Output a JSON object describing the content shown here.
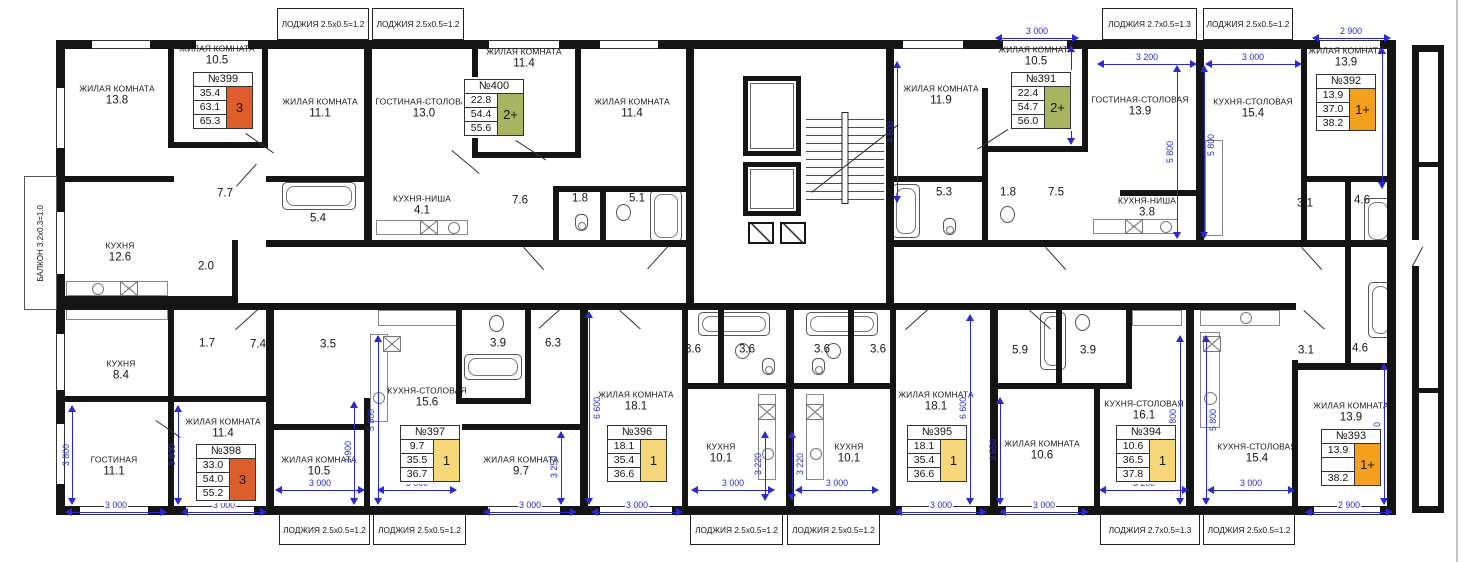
{
  "colors": {
    "wall": "#141414",
    "dimension_blue": "#2a2ad4",
    "badge_3_rooms": "#dd5e2b",
    "badge_2plus_rooms": "#a8b45f",
    "badge_1_room": "#f6d87b",
    "badge_1plus_room": "#f2a01d"
  },
  "balcony_label": "БАЛКОН 3.2х0.3=1.0",
  "loggias": {
    "top": [
      "ЛОДЖИЯ 2.5х0.5=1.2",
      "ЛОДЖИЯ 2.5х0.5=1.2",
      "ЛОДЖИЯ 2.7х0.5=1.3",
      "ЛОДЖИЯ 2.5х0.5=1.2"
    ],
    "bottom": [
      "ЛОДЖИЯ 2.5х0.5=1.2",
      "ЛОДЖИЯ 2.5х0.5=1.2",
      "ЛОДЖИЯ 2.5х0.5=1.2",
      "ЛОДЖИЯ 2.5х0.5=1.2",
      "ЛОДЖИЯ 2.7х0.5=1.3",
      "ЛОДЖИЯ 2.5х0.5=1.2"
    ]
  },
  "apartments": [
    {
      "num": "№399",
      "v1": "35.4",
      "v2": "63.1",
      "v3": "65.3",
      "badge": "3"
    },
    {
      "num": "№400",
      "v1": "22.8",
      "v2": "54.4",
      "v3": "55.6",
      "badge": "2+"
    },
    {
      "num": "№391",
      "v1": "22.4",
      "v2": "54.7",
      "v3": "56.0",
      "badge": "2+"
    },
    {
      "num": "№392",
      "v1": "13.9",
      "v2": "37.0",
      "v3": "38.2",
      "badge": "1+"
    },
    {
      "num": "№398",
      "v1": "33.0",
      "v2": "54.0",
      "v3": "55.2",
      "badge": "3"
    },
    {
      "num": "№397",
      "v1": "9.7",
      "v2": "35.5",
      "v3": "36.7",
      "badge": "1"
    },
    {
      "num": "№396",
      "v1": "18.1",
      "v2": "35.4",
      "v3": "36.6",
      "badge": "1"
    },
    {
      "num": "№395",
      "v1": "18.1",
      "v2": "35.4",
      "v3": "36.6",
      "badge": "1"
    },
    {
      "num": "№394",
      "v1": "10.6",
      "v2": "36.5",
      "v3": "37.8",
      "badge": "1"
    },
    {
      "num": "№393",
      "v1": "13.9",
      "v2": "37.0",
      "v3": "38.2",
      "badge": "1+"
    }
  ],
  "rooms": [
    {
      "n": "ЖИЛАЯ КОМНАТА",
      "a": "13.8"
    },
    {
      "n": "ЖИЛАЯ КОМНАТА",
      "a": "10.5"
    },
    {
      "n": "ЖИЛАЯ КОМНАТА",
      "a": "11.1"
    },
    {
      "n": "",
      "a": "7.7"
    },
    {
      "n": "КУХНЯ",
      "a": "12.6"
    },
    {
      "n": "",
      "a": "2.0"
    },
    {
      "n": "",
      "a": "5.4"
    },
    {
      "n": "ГОСТИНАЯ-СТОЛОВАЯ",
      "a": "13.0"
    },
    {
      "n": "ЖИЛАЯ КОМНАТА",
      "a": "11.4"
    },
    {
      "n": "ЖИЛАЯ КОМНАТА",
      "a": "11.4"
    },
    {
      "n": "КУХНЯ-НИША",
      "a": "4.1"
    },
    {
      "n": "",
      "a": "7.6"
    },
    {
      "n": "",
      "a": "1.8"
    },
    {
      "n": "",
      "a": "5.1"
    },
    {
      "n": "ЖИЛАЯ КОМНАТА",
      "a": "11.9"
    },
    {
      "n": "",
      "a": "5.3"
    },
    {
      "n": "",
      "a": "1.8"
    },
    {
      "n": "",
      "a": "7.5"
    },
    {
      "n": "ЖИЛАЯ КОМНАТА",
      "a": "10.5"
    },
    {
      "n": "ГОСТИНАЯ-СТОЛОВАЯ",
      "a": "13.9"
    },
    {
      "n": "КУХНЯ-НИША",
      "a": "3.8"
    },
    {
      "n": "КУХНЯ-СТОЛОВАЯ",
      "a": "15.4"
    },
    {
      "n": "ЖИЛАЯ КОМНАТА",
      "a": "13.9"
    },
    {
      "n": "",
      "a": "3.1"
    },
    {
      "n": "",
      "a": "4.6"
    },
    {
      "n": "",
      "a": "1.7"
    },
    {
      "n": "",
      "a": "7.4"
    },
    {
      "n": "",
      "a": "3.5"
    },
    {
      "n": "",
      "a": "3.9"
    },
    {
      "n": "",
      "a": "6.3"
    },
    {
      "n": "КУХНЯ",
      "a": "8.4"
    },
    {
      "n": "ГОСТИНАЯ",
      "a": "11.1"
    },
    {
      "n": "ЖИЛАЯ КОМНАТА",
      "a": "11.4"
    },
    {
      "n": "ЖИЛАЯ КОМНАТА",
      "a": "10.5"
    },
    {
      "n": "КУХНЯ-СТОЛОВАЯ",
      "a": "15.6"
    },
    {
      "n": "ЖИЛАЯ КОМНАТА",
      "a": "9.7"
    },
    {
      "n": "",
      "a": "3.6"
    },
    {
      "n": "",
      "a": "3.6"
    },
    {
      "n": "",
      "a": "3.6"
    },
    {
      "n": "",
      "a": "3.6"
    },
    {
      "n": "ЖИЛАЯ КОМНАТА",
      "a": "18.1"
    },
    {
      "n": "КУХНЯ",
      "a": "10.1"
    },
    {
      "n": "КУХНЯ",
      "a": "10.1"
    },
    {
      "n": "ЖИЛАЯ КОМНАТА",
      "a": "18.1"
    },
    {
      "n": "",
      "a": "5.9"
    },
    {
      "n": "",
      "a": "3.9"
    },
    {
      "n": "ЖИЛАЯ КОМНАТА",
      "a": "10.6"
    },
    {
      "n": "КУХНЯ-СТОЛОВАЯ",
      "a": "16.1"
    },
    {
      "n": "КУХНЯ-СТОЛОВАЯ",
      "a": "15.4"
    },
    {
      "n": "",
      "a": "3.1"
    },
    {
      "n": "",
      "a": "4.6"
    },
    {
      "n": "ЖИЛАЯ КОМНАТА",
      "a": "13.9"
    }
  ],
  "dims": [
    "4 600",
    "3 000",
    "3 464",
    "3 200",
    "5 800",
    "5 800",
    "3 000",
    "2 900",
    "4 900",
    "3 800",
    "3 800",
    "3 000",
    "3 000",
    "3 900",
    "5 800",
    "3 000",
    "3 000",
    "3 250",
    "6 600",
    "3 000",
    "3 000",
    "3 220",
    "3 220",
    "3 000",
    "3 000",
    "6 600",
    "3 000",
    "3 550",
    "3 000",
    "5 800",
    "3 200",
    "5 800",
    "3 000",
    "4 900",
    "2 900"
  ]
}
